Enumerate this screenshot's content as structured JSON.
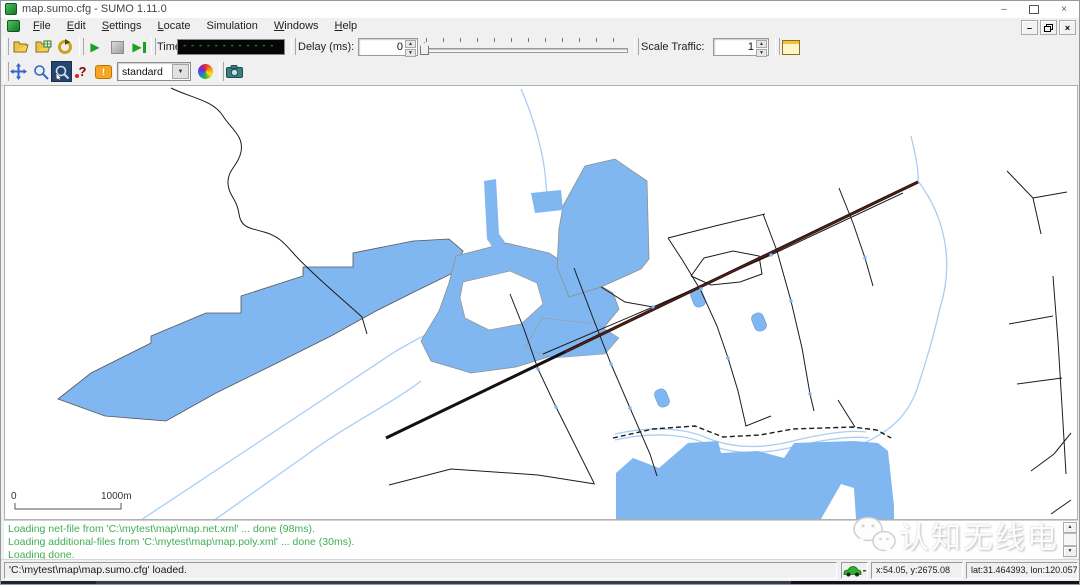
{
  "window": {
    "title": "map.sumo.cfg - SUMO 1.11.0"
  },
  "menu": {
    "items": [
      {
        "label": "File"
      },
      {
        "label": "Edit"
      },
      {
        "label": "Settings"
      },
      {
        "label": "Locate"
      },
      {
        "label": "Simulation"
      },
      {
        "label": "Windows"
      },
      {
        "label": "Help"
      }
    ]
  },
  "toolbar": {
    "time_label": "Time:",
    "time_display": "--------------",
    "delay_label": "Delay (ms):",
    "delay_value": "0",
    "scale_traffic_label": "Scale Traffic:",
    "scale_traffic_value": "1"
  },
  "view_toolbar": {
    "scheme": "standard"
  },
  "map": {
    "scale_zero": "0",
    "scale_distance": "1000m"
  },
  "log": {
    "lines": [
      "Loading net-file from 'C:\\mytest\\map\\map.net.xml' ... done (98ms).",
      "Loading additional-files from 'C:\\mytest\\map\\map.poly.xml' ... done (30ms).",
      "Loading done."
    ]
  },
  "status": {
    "message": "'C:\\mytest\\map\\map.sumo.cfg' loaded.",
    "coords_xy": "x:54.05, y:2675.08",
    "coords_latlon": "lat:31.464393, lon:120.057947"
  },
  "watermark": {
    "text": "认知无线电"
  },
  "glyphs": {
    "play": "▶",
    "minimize": "–",
    "close": "×",
    "spinner_up": "▲",
    "spinner_down": "▼",
    "dropdown_arrow": "▼",
    "scroll_up": "▲",
    "scroll_down": "▼",
    "question": "?",
    "bubble_mark": "!"
  },
  "colors": {
    "water": "#80B7F0",
    "waterway": "#A9CDF5",
    "railway": "#5E1B12",
    "log_text": "#3FAE54",
    "selected_tool_bg": "#24466E"
  }
}
